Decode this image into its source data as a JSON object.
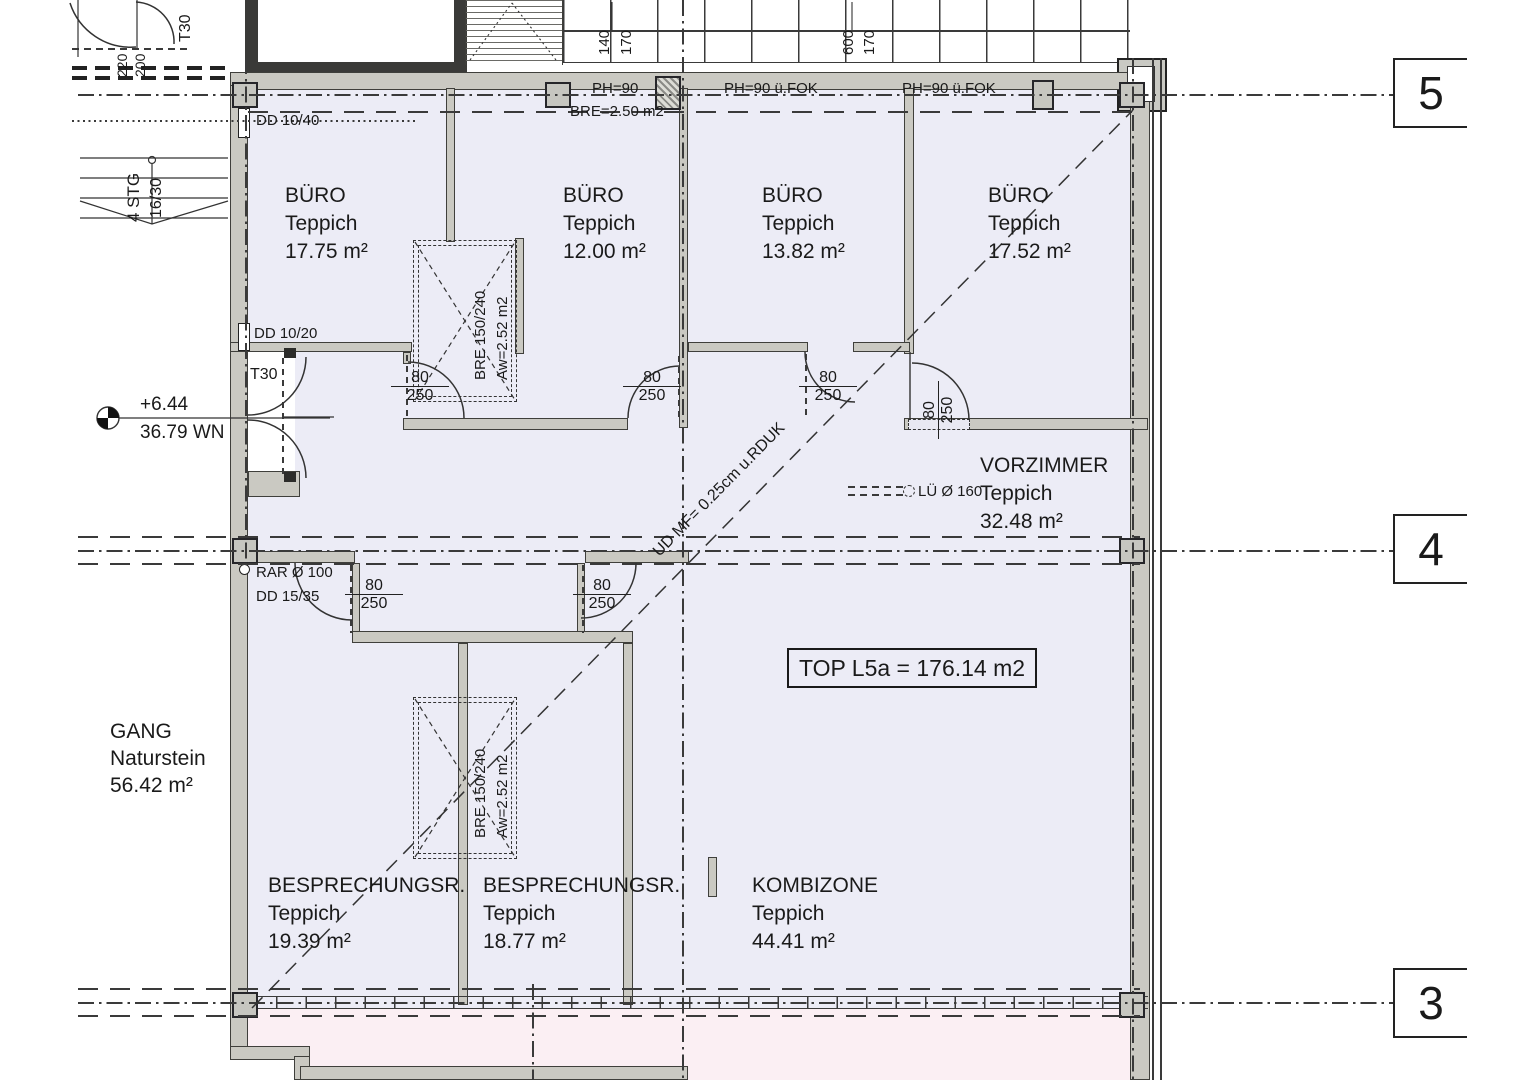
{
  "unit_label": "TOP L5a = 176.14 m2",
  "grid_markers": {
    "top": "5",
    "middle": "4",
    "bottom": "3"
  },
  "rooms": [
    {
      "name": "BÜRO",
      "floor": "Teppich",
      "area": "17.75 m²"
    },
    {
      "name": "BÜRO",
      "floor": "Teppich",
      "area": "12.00 m²"
    },
    {
      "name": "BÜRO",
      "floor": "Teppich",
      "area": "13.82 m²"
    },
    {
      "name": "BÜRO",
      "floor": "Teppich",
      "area": "17.52 m²"
    },
    {
      "name": "VORZIMMER",
      "floor": "Teppich",
      "area": "32.48 m²"
    },
    {
      "name": "BESPRECHUNGSR.",
      "floor": "Teppich",
      "area": "19.39 m²"
    },
    {
      "name": "BESPRECHUNGSR.",
      "floor": "Teppich",
      "area": "18.77 m²"
    },
    {
      "name": "KOMBIZONE",
      "floor": "Teppich",
      "area": "44.41 m²"
    },
    {
      "name": "GANG",
      "floor": "Naturstein",
      "area": "56.42 m²"
    }
  ],
  "level_marker": {
    "elevation": "+6.44",
    "reference": "36.79 WN"
  },
  "door_label": {
    "width": "80",
    "height": "250"
  },
  "fire_door_label": "T30",
  "annotations": {
    "dd_top": "DD 10/40",
    "dd_mid": "DD 10/20",
    "rar": "RAR Ø 100",
    "dd_low": "DD 15/35",
    "lue": "LÜ Ø 160",
    "ud_diagonal": "UD MF= 0.25cm u.RDUK",
    "bre_area": "BRE=2.50 m2",
    "ph_1": "PH=90",
    "ph_2": "PH=90 ü.FOK",
    "ph_3": "PH=90 ü.FOK"
  },
  "shaft_label": {
    "line1": "BRE 150/240",
    "line2": "Aw=2.52 m2"
  },
  "stair": {
    "steps": "4 STG",
    "riser": "16/30"
  },
  "dimensions": {
    "top_a": "140",
    "top_b": "170",
    "top_c": "600",
    "top_d": "170",
    "left_a": "220",
    "left_b": "200"
  },
  "colors": {
    "interior": "#ececf6",
    "lower_zone": "#fbeff3",
    "wall": "#cac9c2",
    "line": "#3a3a3a"
  }
}
